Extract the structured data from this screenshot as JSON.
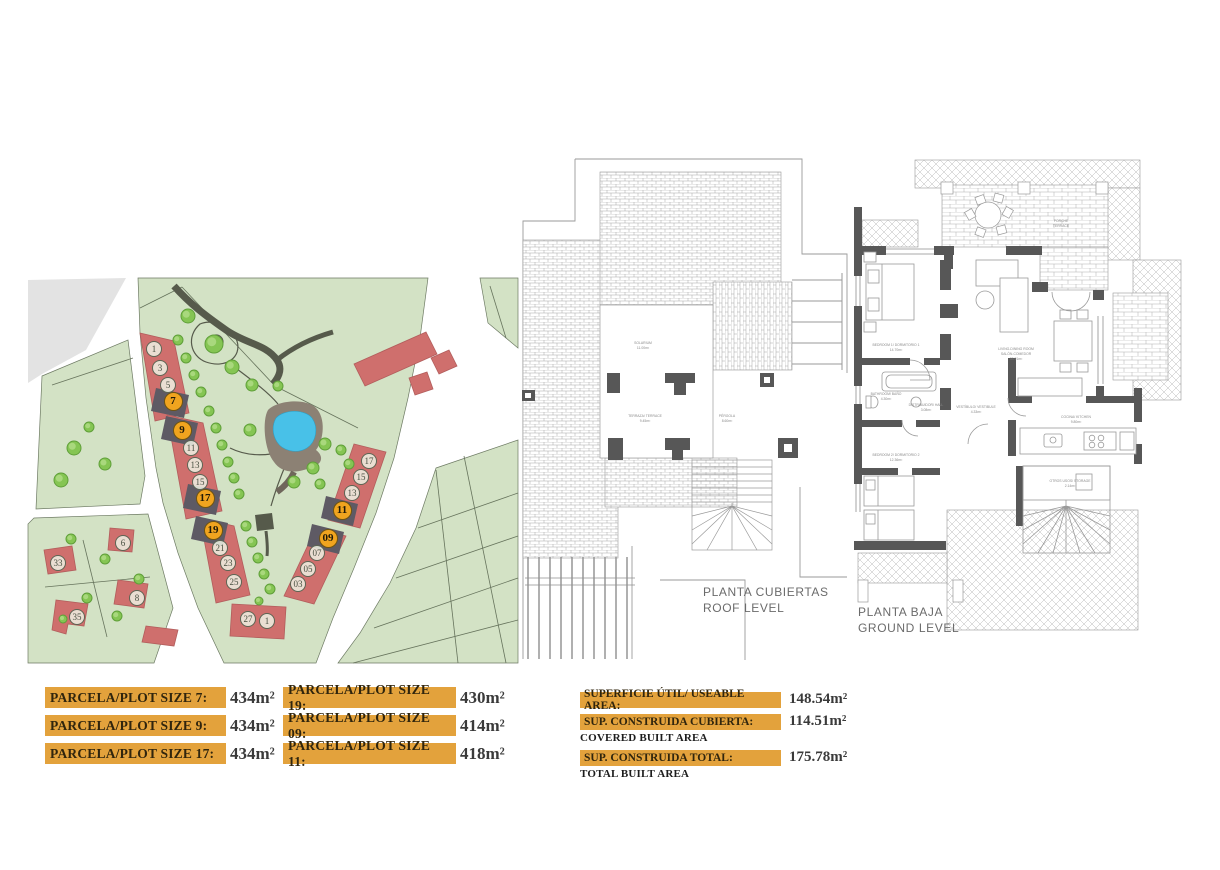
{
  "colors": {
    "bar_orange": "#e3a23c",
    "map_green": "#d3e2c5",
    "map_gray": "#e3e3e3",
    "building_red": "#cf6f6d",
    "marker_orange": "#f0a41f",
    "road_dark": "#565a4b",
    "pool_blue": "#48c1e8",
    "pool_deck": "#8c8174",
    "tree_green": "#85c553",
    "wall_dark": "#575757",
    "plan_line": "#9a9a9a"
  },
  "site_plan": {
    "markers": [
      {
        "n": "1",
        "x": 126,
        "y": 71,
        "h": false
      },
      {
        "n": "3",
        "x": 132,
        "y": 90,
        "h": false
      },
      {
        "n": "5",
        "x": 140,
        "y": 107,
        "h": false
      },
      {
        "n": "7",
        "x": 145,
        "y": 123,
        "h": true
      },
      {
        "n": "9",
        "x": 154,
        "y": 152,
        "h": true
      },
      {
        "n": "11",
        "x": 163,
        "y": 170,
        "h": false
      },
      {
        "n": "13",
        "x": 167,
        "y": 187,
        "h": false
      },
      {
        "n": "15",
        "x": 172,
        "y": 204,
        "h": false
      },
      {
        "n": "17",
        "x": 177,
        "y": 220,
        "h": true
      },
      {
        "n": "19",
        "x": 185,
        "y": 252,
        "h": true
      },
      {
        "n": "21",
        "x": 192,
        "y": 270,
        "h": false
      },
      {
        "n": "23",
        "x": 200,
        "y": 285,
        "h": false
      },
      {
        "n": "25",
        "x": 206,
        "y": 304,
        "h": false
      },
      {
        "n": "27",
        "x": 220,
        "y": 341,
        "h": false
      },
      {
        "n": "1",
        "x": 239,
        "y": 343,
        "h": false
      },
      {
        "n": "17",
        "x": 341,
        "y": 183,
        "h": false
      },
      {
        "n": "15",
        "x": 333,
        "y": 199,
        "h": false
      },
      {
        "n": "13",
        "x": 324,
        "y": 215,
        "h": false
      },
      {
        "n": "11",
        "x": 314,
        "y": 232,
        "h": true
      },
      {
        "n": "09",
        "x": 300,
        "y": 260,
        "h": true
      },
      {
        "n": "07",
        "x": 289,
        "y": 275,
        "h": false
      },
      {
        "n": "05",
        "x": 280,
        "y": 291,
        "h": false
      },
      {
        "n": "03",
        "x": 270,
        "y": 306,
        "h": false
      },
      {
        "n": "33",
        "x": 30,
        "y": 285,
        "h": false
      },
      {
        "n": "6",
        "x": 95,
        "y": 265,
        "h": false
      },
      {
        "n": "35",
        "x": 49,
        "y": 339,
        "h": false
      },
      {
        "n": "8",
        "x": 109,
        "y": 320,
        "h": false
      }
    ]
  },
  "plot_sizes": {
    "col1": [
      {
        "label": "PARCELA/PLOT SIZE 7:",
        "value": "434m²"
      },
      {
        "label": "PARCELA/PLOT SIZE 9:",
        "value": "434m²"
      },
      {
        "label": "PARCELA/PLOT SIZE 17:",
        "value": "434m²"
      }
    ],
    "col2": [
      {
        "label": "PARCELA/PLOT SIZE 19:",
        "value": "430m²"
      },
      {
        "label": "PARCELA/PLOT SIZE 09:",
        "value": "414m²"
      },
      {
        "label": "PARCELA/PLOT SIZE 11:",
        "value": "418m²"
      }
    ]
  },
  "areas": [
    {
      "label": "SUPERFICIE ÚTIL/ USEABLE AREA:",
      "sublabel": "",
      "value": "148.54m²"
    },
    {
      "label": "SUP. CONSTRUIDA CUBIERTA:",
      "sublabel": "COVERED BUILT AREA",
      "value": "114.51m²"
    },
    {
      "label": "SUP. CONSTRUIDA TOTAL:",
      "sublabel": "TOTAL BUILT AREA",
      "value": "175.78m²"
    }
  ],
  "floor_plans": {
    "roof": {
      "title_line1": "PLANTA CUBIERTAS",
      "title_line2": "ROOF LEVEL",
      "labels": {
        "solarium_1": "SOLARIUM",
        "solarium_2": "11.00m²",
        "terrace_1": "TERRAZA/ TERRACE",
        "terrace_2": "9.45m²",
        "pergola_1": "PÉRGOLA",
        "pergola_2": "8.60m²"
      }
    },
    "ground": {
      "title_line1": "PLANTA BAJA",
      "title_line2": "GROUND LEVEL",
      "labels": {
        "porch_1": "PORCHE",
        "porch_2": "TERRACE",
        "bed1_1": "BEDROOM 1/ DORMITORIO 1",
        "bed1_2": "14.70m²",
        "living_1": "LIVING-DINING ROOM",
        "living_2": "SALÓN-COMEDOR",
        "living_3": "33.91m²",
        "bath_1": "BATHROOM/ BAÑO",
        "bath_2": "4.30m²",
        "hall_1": "DISTRIBUIDOR/ HALL",
        "hall_2": "3.08m²",
        "vest_1": "VESTÍBULO/ VESTIBULE",
        "vest_2": "4.33m²",
        "kitchen_1": "COCINA/ KITCHEN",
        "kitchen_2": "9.80m²",
        "bed2_1": "BEDROOM 2/ DORMITORIO 2",
        "bed2_2": "12.36m²",
        "porch2_1": "PORCHE",
        "porch2_2": "5.20m²",
        "stairs_1": "OTROS USOS/ STORAGE",
        "stairs_2": "2.14m²"
      }
    }
  }
}
